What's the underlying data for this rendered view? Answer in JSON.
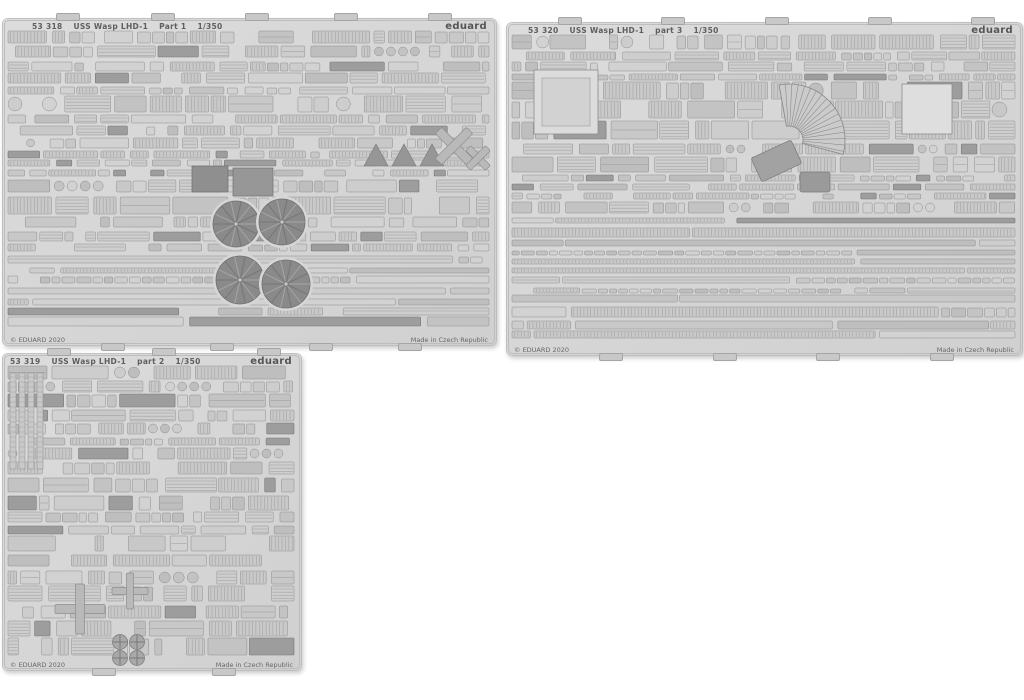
{
  "page": {
    "background": "#ffffff"
  },
  "colors": {
    "sheet_base": "#d6d6d6",
    "sheet_base_light": "#dcdcdc",
    "sheet_base_dark": "#d0d0d0",
    "part_fill": "#cccccc",
    "part_stroke": "#8d8d8d",
    "dark_part": "#9d9d9d",
    "feature_dark": "#8f8f8f",
    "text": "#5e5e5e",
    "tab": "#c8c8c8"
  },
  "sheets": [
    {
      "code": "53 318",
      "kit": "USS Wasp LHD-1",
      "part": "Part 1",
      "scale": "1/350",
      "brand": "eduard",
      "copyright": "© EDUARD 2020",
      "made_in": "Made in Czech Republic"
    },
    {
      "code": "53 320",
      "kit": "USS Wasp LHD-1",
      "part": "part 3",
      "scale": "1/350",
      "brand": "eduard",
      "copyright": "© EDUARD 2020",
      "made_in": "Made in Czech Republic"
    },
    {
      "code": "53 319",
      "kit": "USS Wasp LHD-1",
      "part": "part 2",
      "scale": "1/350",
      "brand": "eduard",
      "copyright": "© EDUARD 2020",
      "made_in": "Made in Czech Republic"
    }
  ]
}
